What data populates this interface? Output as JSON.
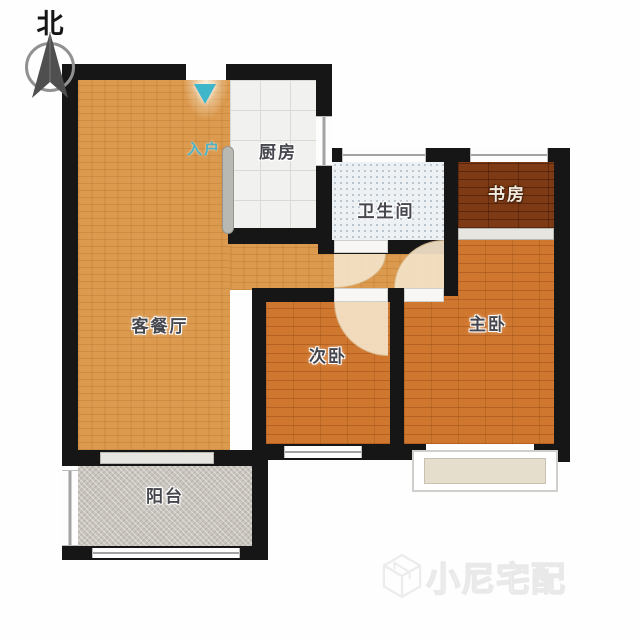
{
  "compass": {
    "north_label": "北"
  },
  "entry": {
    "label": "入户"
  },
  "rooms": {
    "living": {
      "label": "客餐厅"
    },
    "kitchen": {
      "label": "厨房"
    },
    "bathroom": {
      "label": "卫生间"
    },
    "study": {
      "label": "书房"
    },
    "master_bedroom": {
      "label": "主卧"
    },
    "second_bedroom": {
      "label": "次卧"
    },
    "balcony": {
      "label": "阳台"
    }
  },
  "watermark": {
    "brand": "小尼宅配"
  },
  "colors": {
    "wall": "#161616",
    "living_floor": "#dc9a4f",
    "bedroom_floor": "#d0772f",
    "study_floor": "#7d3a14",
    "kitchen_floor": "#f1f1ef",
    "bathroom_floor": "#eef1f3",
    "balcony_floor": "#c9c5be",
    "entry_accent": "#3fb6c9",
    "door_arc": "#f4e4c8"
  }
}
